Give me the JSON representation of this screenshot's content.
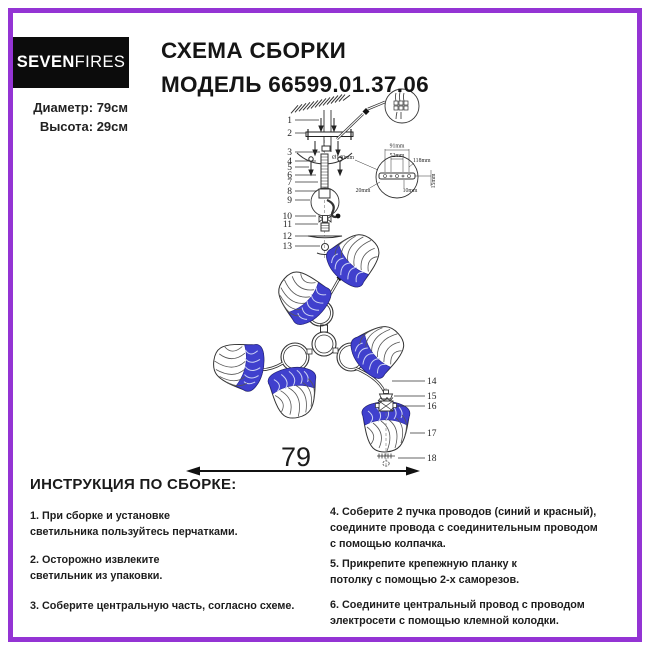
{
  "brand": {
    "bold": "SEVEN",
    "light": "FIRES"
  },
  "header": {
    "title_line1": "СХЕМА СБОРКИ",
    "title_line2": "МОДЕЛЬ 66599.01.37.06"
  },
  "specs": {
    "diameter": "Диаметр: 79см",
    "height": "Высота: 29см"
  },
  "diagram": {
    "callouts_left": [
      "1",
      "2",
      "3",
      "4",
      "5",
      "6",
      "7",
      "8",
      "9",
      "10",
      "11",
      "12",
      "13"
    ],
    "callouts_right": [
      "14",
      "15",
      "16",
      "17",
      "18"
    ],
    "dimensions": {
      "d91": "91mm",
      "d52": "52mm",
      "d118": "118mm",
      "d_dia": "Ø140mm",
      "d20": "20mm",
      "d10": "10mm",
      "d15": "15mm",
      "width": "79"
    },
    "accent_blue": "#4040cd",
    "line_color": "#333333"
  },
  "instructions": {
    "heading": "ИНСТРУКЦИЯ ПО СБОРКЕ:",
    "left": [
      "1. При сборке и установке\nсветильника пользуйтесь перчатками.",
      "2. Осторожно извлеките\nсветильник из упаковки.",
      "3. Соберите центральную часть, согласно схеме."
    ],
    "right": [
      "4. Соберите 2 пучка проводов (синий и красный),\nсоедините провода с соединительным проводом\nс помощью колпачка.",
      "5. Прикрепите крепежную планку к\nпотолку с помощью 2-х саморезов.",
      "6. Соедините центральный провод с проводом\nэлектросети с помощью клемной колодки."
    ]
  }
}
